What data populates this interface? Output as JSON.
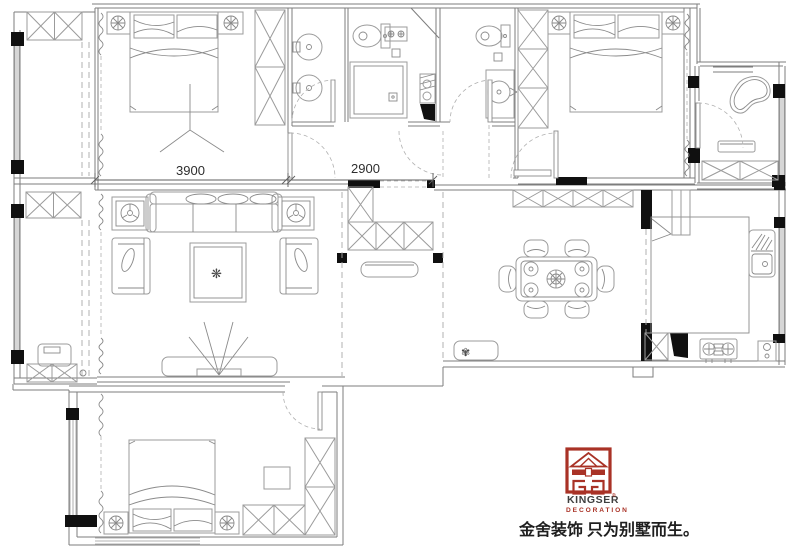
{
  "floorplan": {
    "dimensions": {
      "bedroom_width": "3900",
      "hall_width": "2900"
    }
  },
  "brand": {
    "name": "KINGSER",
    "reg": "®",
    "subtitle": "DECORATION",
    "tagline": "金舍装饰 只为别墅而生。",
    "logo_color": "#a93226",
    "name_color": "#3f3f3f"
  },
  "icons": {
    "rug_flower": "❋",
    "dining_plant": "✾"
  }
}
